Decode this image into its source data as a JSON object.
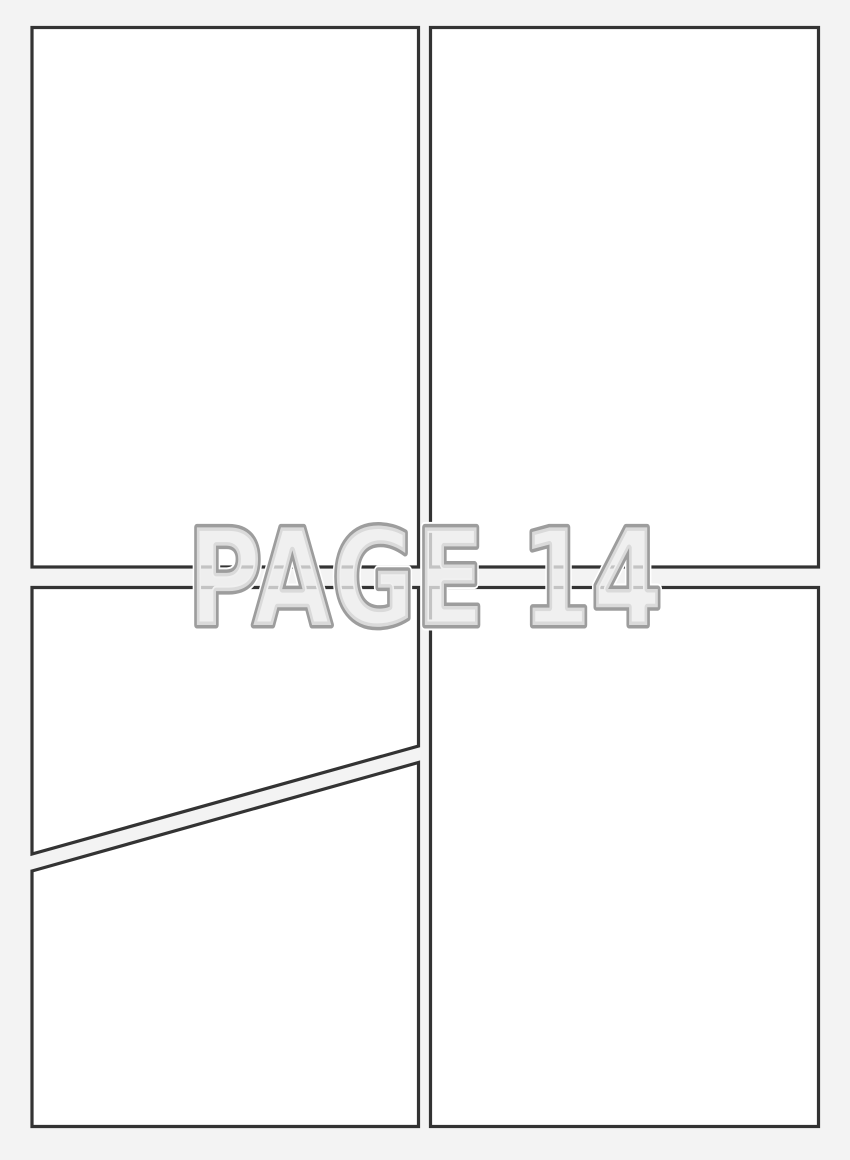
{
  "page": {
    "label": "PAGE 14",
    "panel_count": 5,
    "colors": {
      "background": "#f3f3f3",
      "panel_fill": "#ffffff",
      "panel_border": "#333333",
      "label_fill": "#ececec",
      "label_outline": "#9d9d9d",
      "label_glow": "#ffffff"
    }
  }
}
